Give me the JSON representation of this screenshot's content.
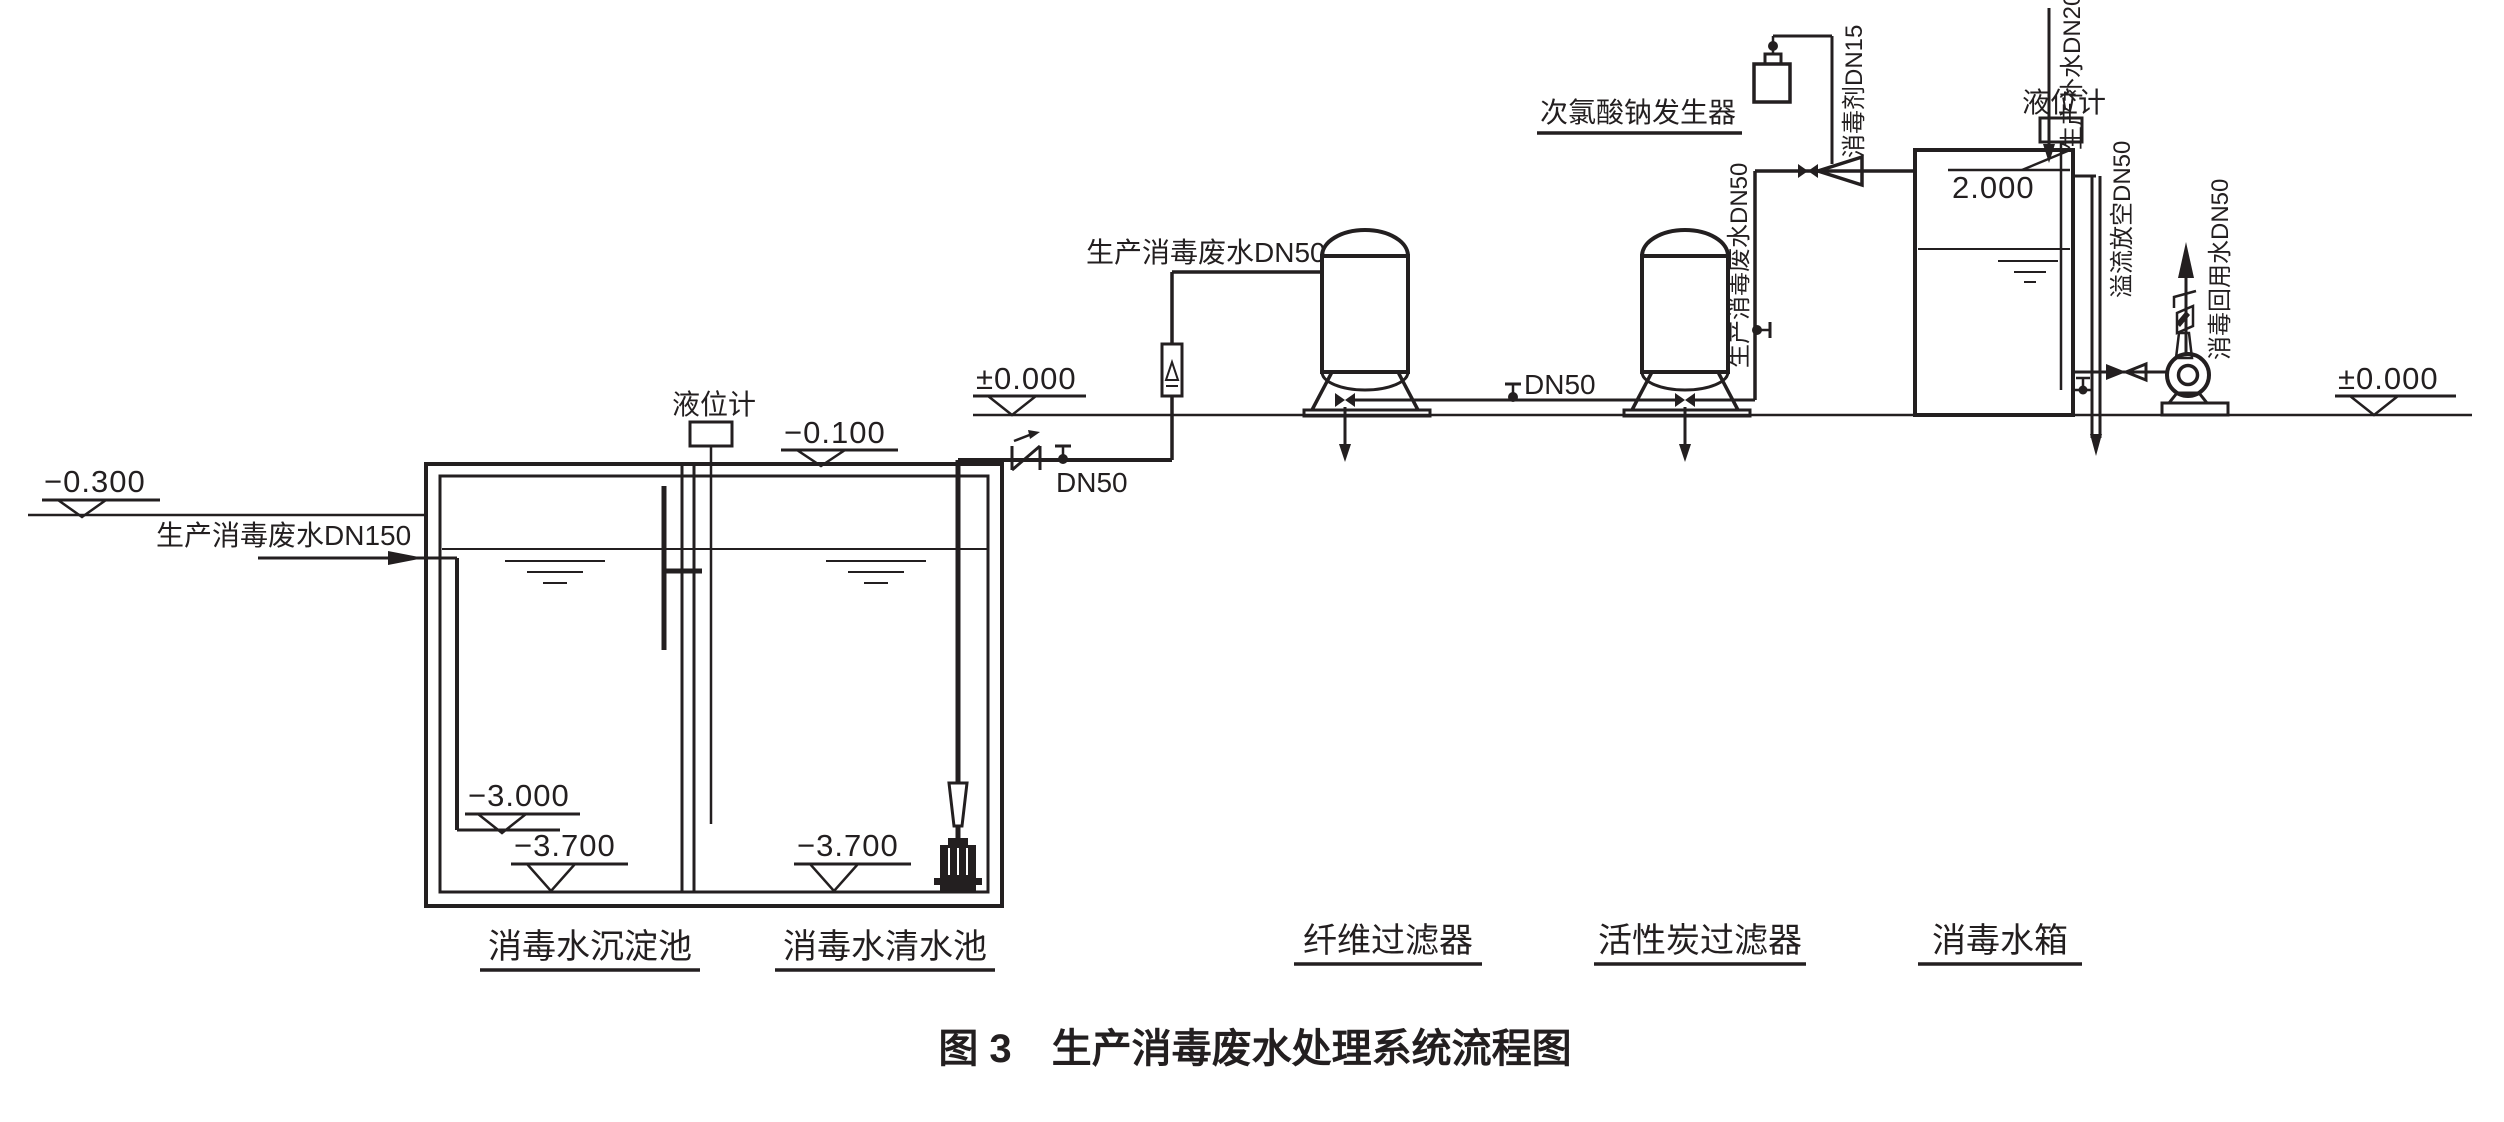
{
  "title": "图 3　生产消毒废水处理系统流程图",
  "colors": {
    "line": "#231f20",
    "background": "#ffffff"
  },
  "equipment": {
    "sedimentation_tank": "消毒水沉淀池",
    "clear_water_tank": "消毒水清水池",
    "fiber_filter": "纤维过滤器",
    "carbon_filter": "活性炭过滤器",
    "disinfection_tank": "消毒水箱",
    "hypochlorite_generator": "次氯酸钠发生器"
  },
  "instruments": {
    "level_gauge_left": "液位计",
    "level_gauge_right": "液位计"
  },
  "pipe_labels": {
    "inlet": "生产消毒废水DN150",
    "clear_tank_outlet": "DN50",
    "to_fiber_filter": "生产消毒废水DN50",
    "between_filters": "DN50",
    "to_disinfection_tank": "生产消毒废水DN50",
    "disinfectant": "消毒剂DN15",
    "makeup_water": "生产补水DN20",
    "overflow_drain": "溢流放空DN50",
    "reuse_water": "消毒回用水DN50"
  },
  "elevations": {
    "left_ground": "−0.300",
    "clear_tank_top": "−0.100",
    "platform_ground": "±0.000",
    "inlet_pipe_bottom": "−3.000",
    "sedimentation_bottom": "−3.700",
    "clear_water_bottom": "−3.700",
    "disinfection_tank_top": "2.000",
    "right_ground": "±0.000"
  }
}
